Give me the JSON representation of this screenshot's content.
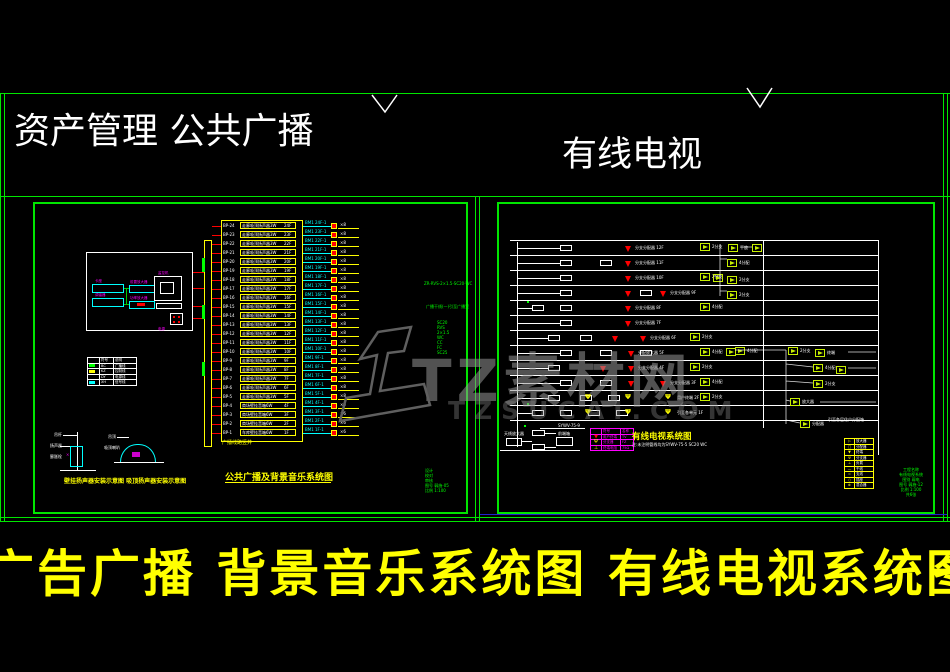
{
  "header": {
    "left_title": "资产管理  公共广播",
    "right_title": "有线电视"
  },
  "footer": {
    "title": "广告广播 背景音乐系统图  有线电视系统图",
    "dash": "一"
  },
  "watermark": {
    "text": "TZ素材网",
    "subtext": "TZSUCAI.COM"
  },
  "pa": {
    "caption": "公共广播及背景音乐系统图",
    "shaft_label": "广播线路竖井",
    "detail_caption": "壁挂扬声器安装示意图  吸顶扬声器安装示意图",
    "cable_note": "ZR-RVS-2×1.5-SC20-WC",
    "feeder_note": "广播干线(一)引至广播室",
    "riser_specs": [
      "SC20",
      "RVS",
      "2×1.5",
      "WC",
      "CC",
      "FC",
      "SC25"
    ],
    "equipment_labels": {
      "deck": "卡座",
      "tuner": "调谐器",
      "pre": "前置放大器",
      "power": "功率放大器",
      "monitor": "监控机",
      "psu": "电源"
    },
    "detailA_labels": [
      "吊杆",
      "扬声器",
      "膨胀栓"
    ],
    "detailB_labels": [
      "吊顶",
      "吸顶喇叭"
    ],
    "legend": {
      "rows": [
        {
          "s": "",
          "t1": "符号",
          "t2": "说明"
        },
        {
          "s": "#00ff00",
          "t1": "BC",
          "t2": "广播线"
        },
        {
          "s": "#ffff00",
          "t1": "KZ",
          "t2": "控制线"
        },
        {
          "s": "",
          "t1": "DY",
          "t2": "电源线"
        },
        {
          "s": "#00ffff",
          "t1": "XH",
          "t2": "信号线"
        }
      ]
    },
    "riser": {
      "rows": [
        {
          "l": "BP-24",
          "n": "走廊吸顶扬声器3W",
          "f": "24F",
          "c": "BM1 24F-1",
          "t": "×8"
        },
        {
          "l": "BP-23",
          "n": "走廊吸顶扬声器3W",
          "f": "23F",
          "c": "BM1 23F-1",
          "t": "×8"
        },
        {
          "l": "BP-22",
          "n": "走廊吸顶扬声器3W",
          "f": "22F",
          "c": "BM1 22F-1",
          "t": "×8"
        },
        {
          "l": "BP-21",
          "n": "走廊吸顶扬声器3W",
          "f": "21F",
          "c": "BM1 21F-1",
          "t": "×8"
        },
        {
          "l": "BP-20",
          "n": "走廊吸顶扬声器3W",
          "f": "20F",
          "c": "BM1 20F-1",
          "t": "×8"
        },
        {
          "l": "BP-19",
          "n": "走廊吸顶扬声器3W",
          "f": "19F",
          "c": "BM1 19F-1",
          "t": "×8"
        },
        {
          "l": "BP-18",
          "n": "走廊吸顶扬声器3W",
          "f": "18F",
          "c": "BM1 18F-1",
          "t": "×8"
        },
        {
          "l": "BP-17",
          "n": "走廊吸顶扬声器3W",
          "f": "17F",
          "c": "BM1 17F-1",
          "t": "×8"
        },
        {
          "l": "BP-16",
          "n": "走廊吸顶扬声器3W",
          "f": "16F",
          "c": "BM1 16F-1",
          "t": "×8"
        },
        {
          "l": "BP-15",
          "n": "走廊吸顶扬声器3W",
          "f": "15F",
          "c": "BM1 15F-1",
          "t": "×8"
        },
        {
          "l": "BP-14",
          "n": "走廊吸顶扬声器3W",
          "f": "14F",
          "c": "BM1 14F-1",
          "t": "×8"
        },
        {
          "l": "BP-13",
          "n": "走廊吸顶扬声器3W",
          "f": "13F",
          "c": "BM1 13F-1",
          "t": "×8"
        },
        {
          "l": "BP-12",
          "n": "走廊吸顶扬声器3W",
          "f": "12F",
          "c": "BM1 12F-1",
          "t": "×8"
        },
        {
          "l": "BP-11",
          "n": "走廊吸顶扬声器3W",
          "f": "11F",
          "c": "BM1 11F-1",
          "t": "×8"
        },
        {
          "l": "BP-10",
          "n": "走廊吸顶扬声器3W",
          "f": "10F",
          "c": "BM1 10F-1",
          "t": "×8"
        },
        {
          "l": "BP-9",
          "n": "走廊吸顶扬声器3W",
          "f": "9F",
          "c": "BM1 9F-1",
          "t": "×8"
        },
        {
          "l": "BP-8",
          "n": "走廊吸顶扬声器3W",
          "f": "8F",
          "c": "BM1 8F-1",
          "t": "×8"
        },
        {
          "l": "BP-7",
          "n": "走廊吸顶扬声器3W",
          "f": "7F",
          "c": "BM1 7F-1",
          "t": "×8"
        },
        {
          "l": "BP-6",
          "n": "走廊吸顶扬声器3W",
          "f": "6F",
          "c": "BM1 6F-1",
          "t": "×8"
        },
        {
          "l": "BP-5",
          "n": "走廊吸顶扬声器3W",
          "f": "5F",
          "c": "BM1 5F-1",
          "t": "×8"
        },
        {
          "l": "BP-4",
          "n": "商场壁挂音箱6W",
          "f": "4F",
          "c": "BM1 4F-1",
          "t": "×6"
        },
        {
          "l": "BP-3",
          "n": "商场壁挂音箱6W",
          "f": "3F",
          "c": "BM1 3F-1",
          "t": "×6"
        },
        {
          "l": "BP-2",
          "n": "商场壁挂音箱6W",
          "f": "2F",
          "c": "BM1 2F-1",
          "t": "×6"
        },
        {
          "l": "BP-1",
          "n": "车库壁挂音箱6W",
          "f": "1F",
          "c": "BM1 1F-1",
          "t": "×6"
        }
      ]
    },
    "info_lines": [
      "设计",
      "校对",
      "审核",
      "图号 弱施-05",
      "比例 1:100"
    ]
  },
  "catv": {
    "title": "有线电视系统图",
    "note": "注:未注明管线均为SYWV-75-5 SC20 WC",
    "cable_label": "SYWV-75-9",
    "riser_label": "引至各层住户分配箱",
    "headend_labels": {
      "l1": "天线放大器",
      "l2": "混合器",
      "l3": "前端箱"
    },
    "floors": [
      {
        "f": "12F",
        "b": [
          560
        ],
        "a": [
          625
        ],
        "t": "分支分配器",
        "p": [],
        "m": [
          {
            "x": 700,
            "l": "2分支"
          }
        ]
      },
      {
        "f": "11F",
        "b": [
          560,
          600
        ],
        "a": [
          625
        ],
        "t": "分支分配器",
        "p": [],
        "m": []
      },
      {
        "f": "10F",
        "b": [
          560
        ],
        "a": [
          625
        ],
        "t": "分支分配器",
        "p": [],
        "m": [
          {
            "x": 700,
            "l": "2分支"
          }
        ]
      },
      {
        "f": "9F",
        "b": [
          560,
          640
        ],
        "a": [
          625,
          660
        ],
        "t": "分支分配器",
        "p": [],
        "m": []
      },
      {
        "f": "8F",
        "b": [
          532,
          560
        ],
        "a": [
          625
        ],
        "t": "分支分配器",
        "p": [],
        "m": [
          {
            "x": 700,
            "l": "4分配"
          }
        ]
      },
      {
        "f": "7F",
        "b": [
          560
        ],
        "a": [
          625
        ],
        "t": "分支分配器",
        "p": [],
        "m": []
      },
      {
        "f": "6F",
        "b": [
          548,
          580
        ],
        "a": [
          612,
          640
        ],
        "t": "分支分配器",
        "p": [],
        "m": [
          {
            "x": 690,
            "l": "2分支"
          }
        ]
      },
      {
        "f": "5F",
        "b": [
          560,
          600,
          640
        ],
        "a": [
          628
        ],
        "t": "分配放大器",
        "p": [],
        "m": [
          {
            "x": 700,
            "l": "4分配"
          },
          {
            "x": 726,
            "l": ""
          }
        ]
      },
      {
        "f": "4F",
        "b": [
          548
        ],
        "a": [
          600,
          628
        ],
        "t": "分支分配器",
        "p": [],
        "m": [
          {
            "x": 690,
            "l": "2分支"
          }
        ]
      },
      {
        "f": "3F",
        "b": [
          560,
          600
        ],
        "a": [
          628,
          660
        ],
        "t": "分支分配器",
        "p": [],
        "m": [
          {
            "x": 700,
            "l": "4分配"
          }
        ]
      },
      {
        "f": "2F",
        "b": [
          548,
          580,
          608
        ],
        "a": [],
        "t": "用户终端",
        "p": [
          585,
          625,
          665
        ],
        "m": [
          {
            "x": 700,
            "l": "2分支"
          }
        ]
      },
      {
        "f": "1F",
        "b": [
          532,
          560,
          588,
          616
        ],
        "a": [],
        "t": "引至各单元",
        "p": [
          585,
          625,
          665
        ],
        "m": []
      },
      {
        "f": "B1F",
        "b": [],
        "a": [],
        "t": "",
        "p": [],
        "m": []
      }
    ],
    "amps_free": [
      {
        "x": 728,
        "y": 244,
        "l": "干放"
      },
      {
        "x": 752,
        "y": 244,
        "l": ""
      },
      {
        "x": 727,
        "y": 259,
        "l": "4分配"
      },
      {
        "x": 713,
        "y": 274,
        "l": ""
      },
      {
        "x": 727,
        "y": 276,
        "l": "2分支"
      },
      {
        "x": 727,
        "y": 291,
        "l": "2分支"
      },
      {
        "x": 735,
        "y": 347,
        "l": "4分配"
      },
      {
        "x": 788,
        "y": 347,
        "l": "2分支"
      },
      {
        "x": 815,
        "y": 349,
        "l": "终端"
      },
      {
        "x": 813,
        "y": 364,
        "l": "4分配"
      },
      {
        "x": 836,
        "y": 366,
        "l": ""
      },
      {
        "x": 813,
        "y": 380,
        "l": "2分支"
      },
      {
        "x": 790,
        "y": 398,
        "l": "放大器"
      },
      {
        "x": 800,
        "y": 420,
        "l": "分配器"
      }
    ],
    "legend_magenta": {
      "rows": [
        {
          "s": "",
          "sc": "",
          "n": "符号",
          "sp": "名称"
        },
        {
          "s": "▼",
          "sc": "#ff0000",
          "n": "用户终端",
          "sp": "TV"
        },
        {
          "s": "Ψ",
          "sc": "#ffff00",
          "n": "分支器",
          "sp": "FZ"
        },
        {
          "s": "⊥",
          "sc": "#ffff00",
          "n": "终端电阻",
          "sp": "75Ω"
        }
      ]
    },
    "legend_yellow": {
      "rows": [
        {
          "s": "▷",
          "t": "放大器"
        },
        {
          "s": "□",
          "t": "分配器"
        },
        {
          "s": "▼",
          "t": "终端"
        },
        {
          "s": "Ψ",
          "t": "分支器"
        },
        {
          "s": "⊥",
          "t": "负载"
        },
        {
          "s": "—",
          "t": "干线"
        },
        {
          "s": "=",
          "t": "支线"
        },
        {
          "s": "○",
          "t": "插座"
        },
        {
          "s": "⊗",
          "t": "混合器"
        }
      ]
    },
    "info_lines": [
      "工程名称",
      "有线电视系统",
      "图别 弱电",
      "图号 弱施-12",
      "比例 1:100",
      "共6张"
    ]
  }
}
